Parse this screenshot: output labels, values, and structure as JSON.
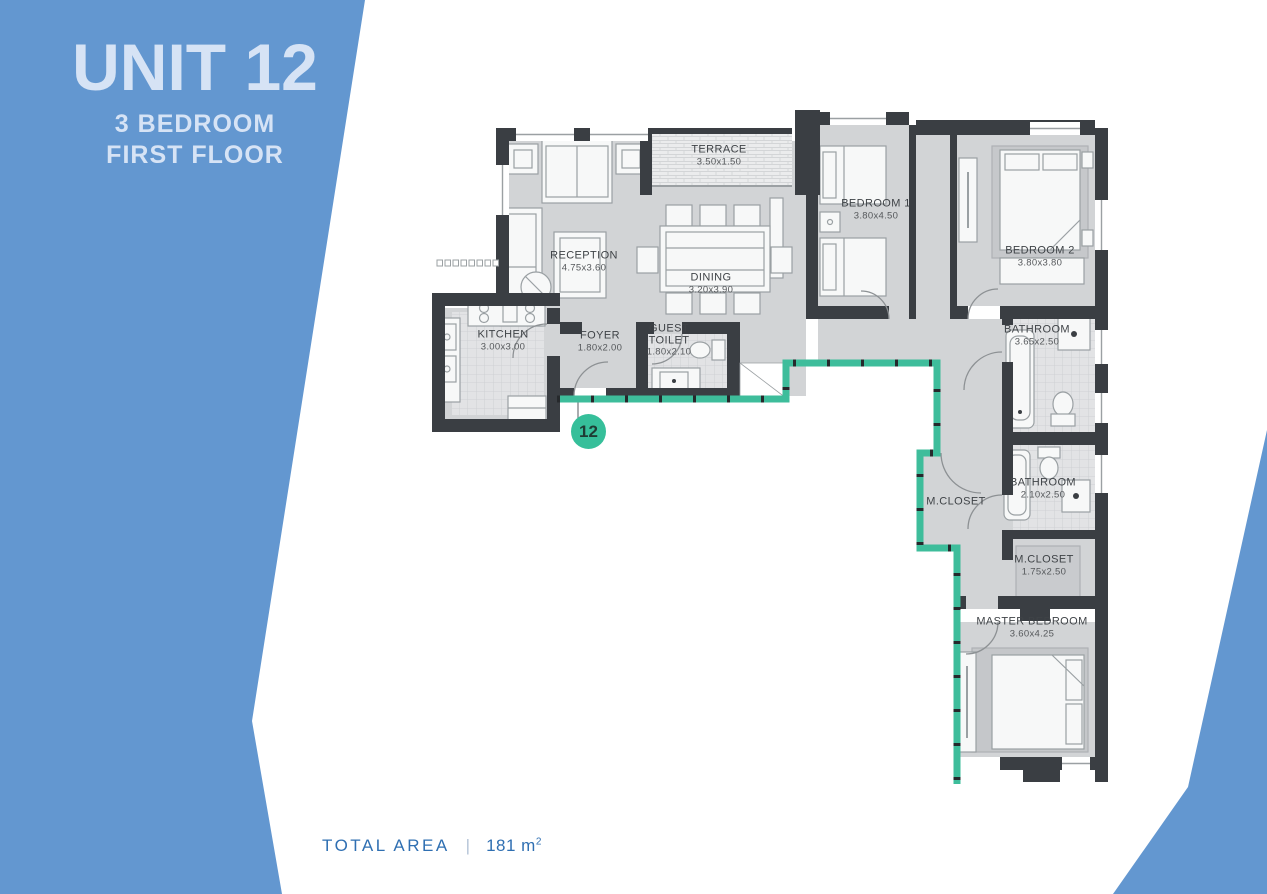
{
  "side_panel": {
    "unit_title": "UNIT 12",
    "subtitle1": "3 BEDROOM",
    "subtitle2": "FIRST FLOOR"
  },
  "footer": {
    "label": "TOTAL AREA",
    "separator": "|",
    "value": "181 m",
    "value_sup": "2"
  },
  "badge": {
    "number": "12"
  },
  "colors": {
    "band": "#6397d0",
    "title_text": "#d6e3f5",
    "footer_text": "#2f6fb2",
    "wall": "#3a3e43",
    "floor": "#d2d4d6",
    "balcony_edge": "#3ebd9b",
    "badge": "#36bf9a"
  },
  "rooms": [
    {
      "id": "terrace",
      "label": "TERRACE",
      "dims": "3.50x1.50",
      "x": 719,
      "y": 156
    },
    {
      "id": "reception",
      "label": "RECEPTION",
      "dims": "4.75x3.60",
      "x": 584,
      "y": 262
    },
    {
      "id": "dining",
      "label": "DINING",
      "dims": "3.20x3.90",
      "x": 711,
      "y": 284
    },
    {
      "id": "bedroom-1",
      "label": "BEDROOM 1",
      "dims": "3.80x4.50",
      "x": 876,
      "y": 210
    },
    {
      "id": "bedroom-2",
      "label": "BEDROOM 2",
      "dims": "3.80x3.80",
      "x": 1040,
      "y": 257
    },
    {
      "id": "kitchen",
      "label": "KITCHEN",
      "dims": "3.00x3.00",
      "x": 503,
      "y": 341
    },
    {
      "id": "foyer",
      "label": "FOYER",
      "dims": "1.80x2.00",
      "x": 600,
      "y": 342
    },
    {
      "id": "guest-toilet",
      "label": "GUEST\nTOILET",
      "dims": "1.80x2.10",
      "x": 669,
      "y": 341
    },
    {
      "id": "bathroom-1",
      "label": "BATHROOM",
      "dims": "3.65x2.50",
      "x": 1037,
      "y": 336
    },
    {
      "id": "m-closet-1",
      "label": "M.CLOSET",
      "dims": "",
      "x": 956,
      "y": 502
    },
    {
      "id": "bathroom-2",
      "label": "BATHROOM",
      "dims": "2.10x2.50",
      "x": 1043,
      "y": 489
    },
    {
      "id": "m-closet-2",
      "label": "M.CLOSET",
      "dims": "1.75x2.50",
      "x": 1044,
      "y": 566
    },
    {
      "id": "master-bedroom",
      "label": "MASTER BEDROOM",
      "dims": "3.60x4.25",
      "x": 1032,
      "y": 628
    }
  ]
}
